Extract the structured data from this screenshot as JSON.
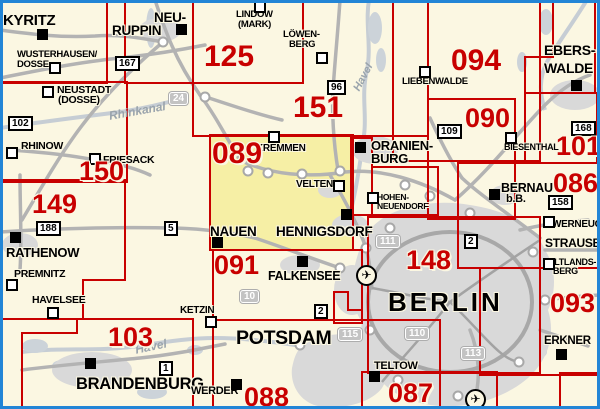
{
  "map": {
    "title": "map-sheet index Berlin/Brandenburg",
    "colors": {
      "background": "#fbf7e2",
      "frame_blue": "#2285d6",
      "sheet_red": "#c80000",
      "highlight_yellow": "#f6efa5",
      "urban_gray": "#d9d9d9",
      "road_gray": "#b3b3b3",
      "water_gray_blue": "#c6cdd4"
    },
    "sheets": [
      {
        "id": "nw-partial",
        "points": "-8,-8 107,-8 107,83 -8,83"
      },
      {
        "id": "125",
        "points": "125,-8 303,-8 303,83 125,83"
      },
      {
        "id": "151",
        "points": "193,-8 428,-8 428,136 193,136"
      },
      {
        "id": "094",
        "points": "393,-8 540,-8 540,161 393,161"
      },
      {
        "id": "eberswalde-partial",
        "points": "525,93 525,57 553,57 553,-8 595,-8 595,93"
      },
      {
        "id": "101",
        "points": "525,93 597,93 597,163 525,163"
      },
      {
        "id": "090",
        "points": "428,99 515,99 515,219 428,219"
      },
      {
        "id": "086",
        "points": "458,163 642,163 642,268 458,268"
      },
      {
        "id": "093",
        "points": "480,268 642,268 642,375 480,375"
      },
      {
        "id": "se-partial",
        "points": "560,373 642,373 642,414 560,414"
      },
      {
        "id": "148",
        "points": "368,217 540,217 540,373 368,373"
      },
      {
        "id": "087",
        "points": "362,372 497,372 497,414 362,414"
      },
      {
        "id": "089",
        "points": "210,135 353,135 353,250 210,250",
        "highlighted": true
      },
      {
        "id": "oranienburg-jog-a",
        "points": "351,138 372,138 372,215 351,215"
      },
      {
        "id": "oranienburg-jog-b",
        "points": "372,167 438,167 438,215 372,215"
      },
      {
        "id": "berlin-west-jog",
        "points": "334,292 348,292 348,310 362,310 362,323 334,323"
      },
      {
        "id": "091",
        "points": "213,250 362,250 362,320 213,320"
      },
      {
        "id": "088",
        "points": "213,320 440,320 440,414 213,414"
      },
      {
        "id": "103",
        "points": "193,319 77,319 77,333 22,333 22,414 193,414"
      },
      {
        "id": "150",
        "points": "-8,82 127,82 127,182 -8,182"
      },
      {
        "id": "149",
        "points": "-8,180 125,180 125,280 83,280 83,319 -8,319"
      }
    ],
    "sheet_labels": [
      {
        "t": "125",
        "x": 204,
        "y": 42,
        "s": 30
      },
      {
        "t": "151",
        "x": 293,
        "y": 93,
        "s": 30
      },
      {
        "t": "094",
        "x": 451,
        "y": 46,
        "s": 30
      },
      {
        "t": "090",
        "x": 465,
        "y": 105,
        "s": 27
      },
      {
        "t": "101",
        "x": 556,
        "y": 133,
        "s": 27
      },
      {
        "t": "086",
        "x": 553,
        "y": 170,
        "s": 27
      },
      {
        "t": "093",
        "x": 550,
        "y": 290,
        "s": 27
      },
      {
        "t": "148",
        "x": 406,
        "y": 247,
        "s": 27
      },
      {
        "t": "089",
        "x": 212,
        "y": 139,
        "s": 30
      },
      {
        "t": "091",
        "x": 214,
        "y": 252,
        "s": 27
      },
      {
        "t": "150",
        "x": 79,
        "y": 158,
        "s": 27
      },
      {
        "t": "149",
        "x": 32,
        "y": 191,
        "s": 27
      },
      {
        "t": "103",
        "x": 108,
        "y": 324,
        "s": 27
      },
      {
        "t": "088",
        "x": 244,
        "y": 384,
        "s": 27
      },
      {
        "t": "087",
        "x": 388,
        "y": 380,
        "s": 27
      }
    ],
    "cities": [
      {
        "t": "KYRITZ",
        "x": 3,
        "y": 13,
        "s": 15
      },
      {
        "t": "WUSTERHAUSEN/",
        "x": 17,
        "y": 50,
        "s": 9.5
      },
      {
        "t": "DOSSE",
        "x": 17,
        "y": 60,
        "s": 9.5
      },
      {
        "t": "NEUSTADT",
        "x": 57,
        "y": 85,
        "s": 10.5
      },
      {
        "t": "(DOSSE)",
        "x": 58,
        "y": 95,
        "s": 10.5
      },
      {
        "t": "RHINOW",
        "x": 21,
        "y": 141,
        "s": 10.5
      },
      {
        "t": "FRIESACK",
        "x": 103,
        "y": 155,
        "s": 10.5
      },
      {
        "t": "RATHENOW",
        "x": 6,
        "y": 246,
        "s": 13
      },
      {
        "t": "PREMNITZ",
        "x": 14,
        "y": 269,
        "s": 10.5
      },
      {
        "t": "HAVELSEE",
        "x": 32,
        "y": 295,
        "s": 10.5
      },
      {
        "t": "BRANDENBURG",
        "x": 76,
        "y": 376,
        "s": 16.5
      },
      {
        "t": "WERDER",
        "x": 191,
        "y": 386,
        "s": 11
      },
      {
        "t": "KETZIN",
        "x": 180,
        "y": 306,
        "s": 10
      },
      {
        "t": "POTSDAM",
        "x": 236,
        "y": 329,
        "s": 19.5
      },
      {
        "t": "NEU-",
        "x": 154,
        "y": 11,
        "s": 13.5
      },
      {
        "t": "RUPPIN",
        "x": 112,
        "y": 24,
        "s": 13.5
      },
      {
        "t": "LINDOW",
        "x": 236,
        "y": 10,
        "s": 9.5
      },
      {
        "t": "(MARK)",
        "x": 238,
        "y": 20,
        "s": 9.5
      },
      {
        "t": "LÖWEN-",
        "x": 283,
        "y": 30,
        "s": 9.5
      },
      {
        "t": "BERG",
        "x": 289,
        "y": 40,
        "s": 9.5
      },
      {
        "t": "KREMMEN",
        "x": 256,
        "y": 144,
        "s": 10
      },
      {
        "t": "VELTEN",
        "x": 296,
        "y": 180,
        "s": 10
      },
      {
        "t": "NAUEN",
        "x": 210,
        "y": 225,
        "s": 13.5
      },
      {
        "t": "HENNIGSDORF",
        "x": 276,
        "y": 225,
        "s": 13.5
      },
      {
        "t": "FALKENSEE",
        "x": 268,
        "y": 270,
        "s": 12.5
      },
      {
        "t": "LIEBENWALDE",
        "x": 402,
        "y": 77,
        "s": 9.5
      },
      {
        "t": "ORANIEN-",
        "x": 371,
        "y": 139,
        "s": 13
      },
      {
        "t": "BURG",
        "x": 371,
        "y": 152,
        "s": 13
      },
      {
        "t": "HOHEN-",
        "x": 377,
        "y": 193,
        "s": 8.5
      },
      {
        "t": "NEUENDORF",
        "x": 377,
        "y": 202,
        "s": 8.5
      },
      {
        "t": "EBERS-",
        "x": 544,
        "y": 43,
        "s": 14
      },
      {
        "t": "WALDE",
        "x": 544,
        "y": 61,
        "s": 14
      },
      {
        "t": "BIESENTHAL",
        "x": 504,
        "y": 143,
        "s": 9
      },
      {
        "t": "BERNAU",
        "x": 501,
        "y": 182,
        "s": 12.5
      },
      {
        "t": "b.B.",
        "x": 506,
        "y": 194,
        "s": 11
      },
      {
        "t": "WERNEUCHEN",
        "x": 552,
        "y": 220,
        "s": 10
      },
      {
        "t": "STRAUSBERG",
        "x": 545,
        "y": 237,
        "s": 12
      },
      {
        "t": "ALTLANDS-",
        "x": 548,
        "y": 258,
        "s": 9
      },
      {
        "t": "BERG",
        "x": 553,
        "y": 267,
        "s": 9
      },
      {
        "t": "ERKNER",
        "x": 544,
        "y": 336,
        "s": 11.5
      },
      {
        "t": "BERLIN",
        "x": 388,
        "y": 289,
        "s": 26,
        "ls": 3
      },
      {
        "t": "TELTOW",
        "x": 374,
        "y": 361,
        "s": 11
      }
    ],
    "markers_black": [
      [
        37,
        29
      ],
      [
        176,
        24
      ],
      [
        10,
        232
      ],
      [
        85,
        358
      ],
      [
        231,
        379
      ],
      [
        212,
        237
      ],
      [
        341,
        209
      ],
      [
        297,
        256
      ],
      [
        355,
        142
      ],
      [
        571,
        80
      ],
      [
        489,
        189
      ],
      [
        556,
        349
      ],
      [
        369,
        371
      ]
    ],
    "markers_white": [
      [
        49,
        62
      ],
      [
        42,
        86
      ],
      [
        6,
        147
      ],
      [
        89,
        153
      ],
      [
        6,
        279
      ],
      [
        47,
        307
      ],
      [
        205,
        316
      ],
      [
        254,
        1
      ],
      [
        316,
        52
      ],
      [
        268,
        131
      ],
      [
        333,
        180
      ],
      [
        419,
        66
      ],
      [
        367,
        192
      ],
      [
        505,
        132
      ],
      [
        543,
        216
      ],
      [
        543,
        258
      ]
    ],
    "road_badges": [
      {
        "t": "167",
        "x": 115,
        "y": 56,
        "type": "b"
      },
      {
        "t": "102",
        "x": 8,
        "y": 116,
        "type": "b"
      },
      {
        "t": "96",
        "x": 327,
        "y": 80,
        "type": "b"
      },
      {
        "t": "109",
        "x": 437,
        "y": 124,
        "type": "b"
      },
      {
        "t": "168",
        "x": 571,
        "y": 121,
        "type": "b"
      },
      {
        "t": "158",
        "x": 548,
        "y": 195,
        "type": "b"
      },
      {
        "t": "2",
        "x": 464,
        "y": 234,
        "type": "b"
      },
      {
        "t": "2",
        "x": 314,
        "y": 304,
        "type": "b"
      },
      {
        "t": "5",
        "x": 164,
        "y": 221,
        "type": "b"
      },
      {
        "t": "188",
        "x": 36,
        "y": 221,
        "type": "b"
      },
      {
        "t": "1",
        "x": 159,
        "y": 361,
        "type": "b"
      },
      {
        "t": "24",
        "x": 169,
        "y": 92,
        "type": "a"
      },
      {
        "t": "10",
        "x": 240,
        "y": 290,
        "type": "a"
      },
      {
        "t": "111",
        "x": 376,
        "y": 235,
        "type": "a"
      },
      {
        "t": "110",
        "x": 405,
        "y": 327,
        "type": "a"
      },
      {
        "t": "113",
        "x": 461,
        "y": 347,
        "type": "a"
      },
      {
        "t": "115",
        "x": 338,
        "y": 328,
        "type": "a"
      }
    ],
    "water_labels": [
      {
        "t": "Rhinkanal",
        "x": 108,
        "y": 110,
        "rot": -10,
        "s": 12
      },
      {
        "t": "Havel",
        "x": 352,
        "y": 88,
        "rot": -62,
        "s": 11
      },
      {
        "t": "Havel",
        "x": 134,
        "y": 344,
        "rot": -12,
        "s": 12
      }
    ],
    "airports": [
      [
        356,
        265
      ],
      [
        465,
        389
      ]
    ],
    "airport_glyph": "✈"
  }
}
